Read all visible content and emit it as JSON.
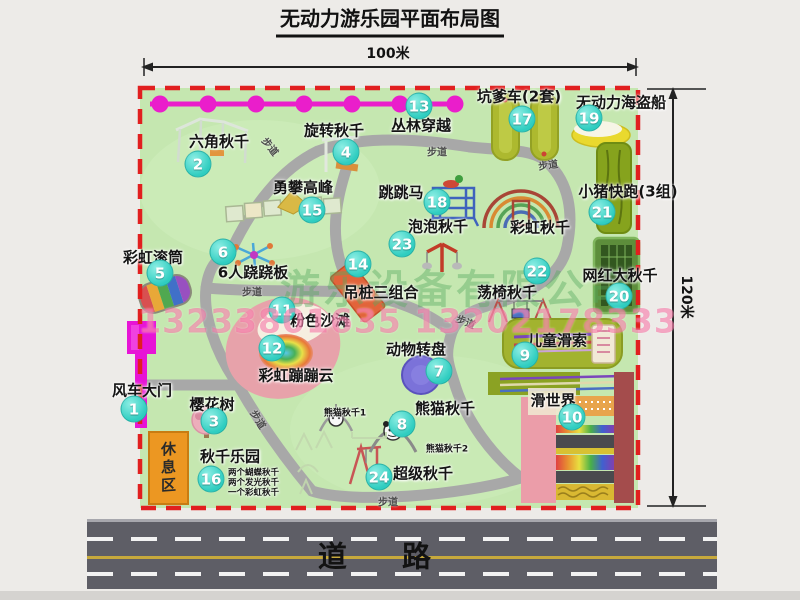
{
  "title": "无动力游乐园平面布局图",
  "dimensions": {
    "width": "100米",
    "height": "120米"
  },
  "road": {
    "label": "道路"
  },
  "watermark": {
    "company": "游乐设备有限公司",
    "phone": "13233801635 13202178333"
  },
  "labels": {
    "path": "步道",
    "rest_area": "休息区",
    "rainbow_swing": "彩虹秋千",
    "panda_swing_1": "熊猫秋千1",
    "panda_swing_2": "熊猫秋千2"
  },
  "swing_park_notes": [
    "两个蝴蝶秋千",
    "两个发光秋千",
    "一个彩虹秋千"
  ],
  "attractions": [
    {
      "num": "1",
      "name": "风车大门"
    },
    {
      "num": "2",
      "name": "六角秋千"
    },
    {
      "num": "3",
      "name": "樱花树"
    },
    {
      "num": "4",
      "name": "旋转秋千"
    },
    {
      "num": "5",
      "name": "彩虹滚筒"
    },
    {
      "num": "6",
      "name": "6人跷跷板"
    },
    {
      "num": "7",
      "name": "动物转盘"
    },
    {
      "num": "8",
      "name": "熊猫秋千"
    },
    {
      "num": "9",
      "name": "儿童滑索"
    },
    {
      "num": "10",
      "name": "滑世界"
    },
    {
      "num": "11",
      "name": "粉色沙滩"
    },
    {
      "num": "12",
      "name": "彩虹蹦蹦云"
    },
    {
      "num": "13",
      "name": "丛林穿越"
    },
    {
      "num": "14",
      "name": "吊桩三组合"
    },
    {
      "num": "15",
      "name": "勇攀高峰"
    },
    {
      "num": "16",
      "name": "秋千乐园"
    },
    {
      "num": "17",
      "name": "坑爹车(2套)"
    },
    {
      "num": "18",
      "name": "跳跳马"
    },
    {
      "num": "19",
      "name": "无动力海盗船"
    },
    {
      "num": "20",
      "name": "网红大秋千"
    },
    {
      "num": "21",
      "name": "小猪快跑(3组)"
    },
    {
      "num": "22",
      "name": "荡椅秋千"
    },
    {
      "num": "23",
      "name": "泡泡秋千"
    },
    {
      "num": "24",
      "name": "超级秋千"
    }
  ],
  "colors": {
    "badge": "#2fcdc0",
    "boundary": "#e11f1f",
    "map_green": "#c5e7b0",
    "zipline": "#e71ccb",
    "road": "#5e5e66"
  }
}
